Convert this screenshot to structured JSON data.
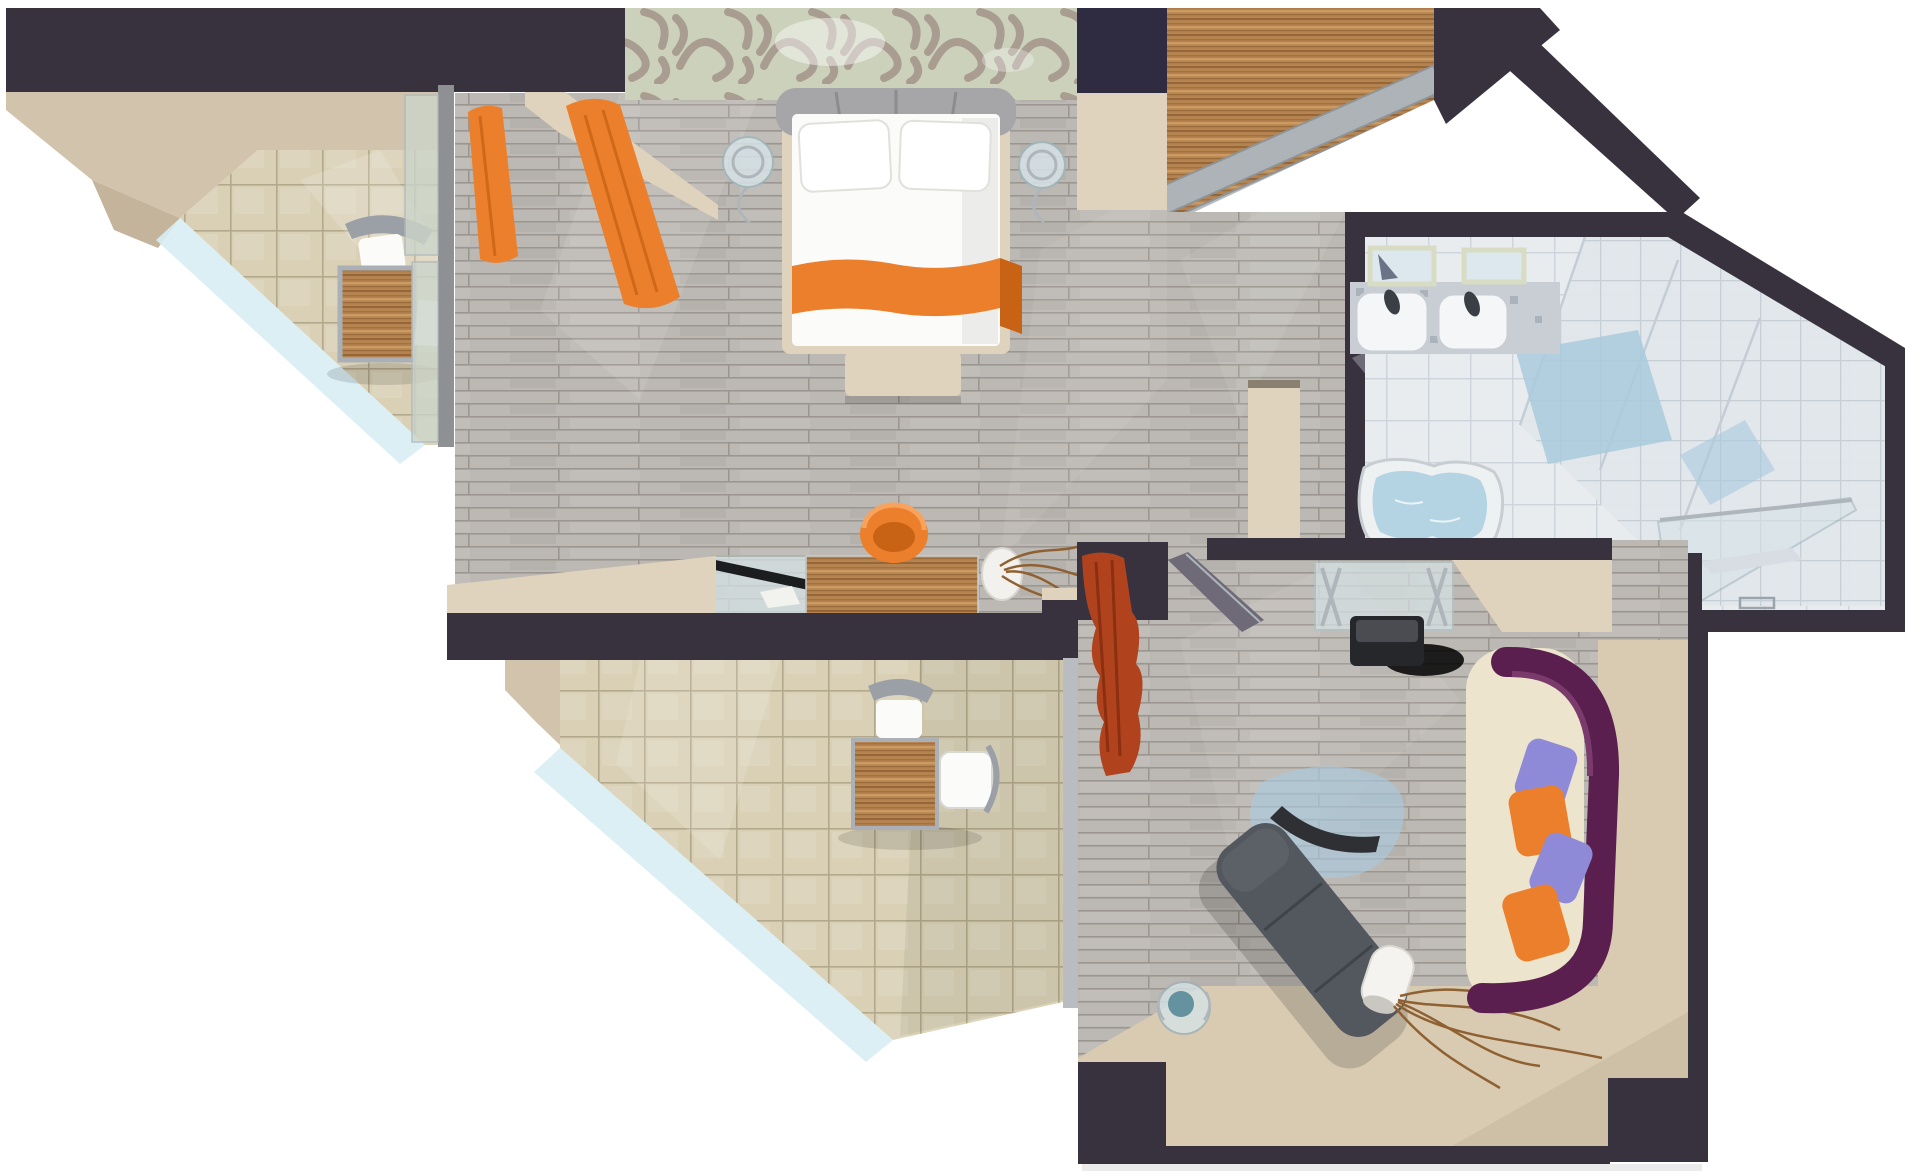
{
  "meta": {
    "title": "3D apartment floor plan — top-down architectural render",
    "view": "top-down cutaway",
    "style": "photorealistic 3D visualization"
  },
  "rooms": [
    {
      "id": "balcony-upper",
      "label": "Upper balcony",
      "floor": "beige ceramic tile",
      "items": [
        "bistro desk",
        "white chair",
        "notepad",
        "glass balustrade"
      ]
    },
    {
      "id": "bedroom",
      "label": "Bedroom",
      "floor": "gray laminate planks",
      "items": [
        "double bed",
        "two pillows",
        "orange bed runner",
        "gray upholstered headboard",
        "glass nightstand left",
        "glass nightstand right",
        "orange curtains",
        "foot bench",
        "writing desk",
        "orange shell chair",
        "glass display case with laptop",
        "vase with twigs",
        "patterned accent wall",
        "wardrobe with sliding doors"
      ]
    },
    {
      "id": "hallway",
      "label": "Hallway",
      "floor": "gray laminate planks",
      "items": [
        "wall console panel",
        "bathroom door"
      ]
    },
    {
      "id": "bathroom",
      "label": "Bathroom",
      "floor": "white tile",
      "items": [
        "double sink counter",
        "two mirrors",
        "faucets",
        "bathtub with water",
        "glass shower enclosure",
        "sloped glass attic roof",
        "blue skylight"
      ]
    },
    {
      "id": "living-room",
      "label": "Living room",
      "floor": "gray laminate planks with beige carpet",
      "items": [
        "TV on glass stand",
        "entry door",
        "rust-red curtain",
        "triangular glass rug",
        "dark boomerang sculpture",
        "chaise longue",
        "glass side table with blue bowl",
        "white vase with branches",
        "sofa with purple backrest",
        "orange cushions",
        "lavender cushions"
      ]
    },
    {
      "id": "balcony-lower",
      "label": "Lower balcony",
      "floor": "beige ceramic tile",
      "items": [
        "desk",
        "two white chairs",
        "glass balustrade"
      ]
    }
  ],
  "palette": {
    "bg": "#ffffff",
    "wall": "#37323e",
    "wallNavy": "#2f2b40",
    "wallLight": "#45404e",
    "beigeCeiling": "#d2c3ac",
    "beigeCeilingDark": "#c4b49c",
    "beigeWall": "#e0d3bd",
    "beigeFloor": "#d8cbb2",
    "beigeFloorDark": "#cdbfa4",
    "tileBeige": "#d9d0b5",
    "tileBeigeLine": "#b2a88b",
    "plank": "#bcb8b3",
    "plankLine": "#9b9690",
    "tileWhite": "#e9ecef",
    "tileWhiteLine": "#ced4db",
    "glassBalustrade": "#d7edf4",
    "glassPane": "#ccd5ca",
    "glassFurniture": "#d6e3e6",
    "roofGlass": "#e2e7ec",
    "roofLine": "#c4ccd5",
    "skylightBlue": "#a9cadd",
    "orange": "#ec7f2b",
    "orangeDark": "#c86315",
    "rust": "#b0431d",
    "rustDark": "#8a2f10",
    "linen": "#fbfbfa",
    "linenShade": "#e6e6e2",
    "headboard": "#a6a6a8",
    "headboardDark": "#8c8c8e",
    "chrome": "#aeb6bc",
    "wood": "#b5834f",
    "woodDark": "#8f6132",
    "woodLight": "#d0a066",
    "sofaSeat": "#ece4cd",
    "sofaPurple": "#5a1f4e",
    "lavender": "#8f8ad8",
    "chaise": "#53575e",
    "chaiseDark": "#3f434a",
    "tvBlack": "#26272a",
    "water": "#b5d4e3",
    "counter": "#c9ced5",
    "mirror": "#dde7ee",
    "doorGray": "#6e6a78",
    "wallpaperBase": "#cbd1ba",
    "wallpaperSwirl": "#a3948b",
    "frameGray": "#8f9094"
  }
}
